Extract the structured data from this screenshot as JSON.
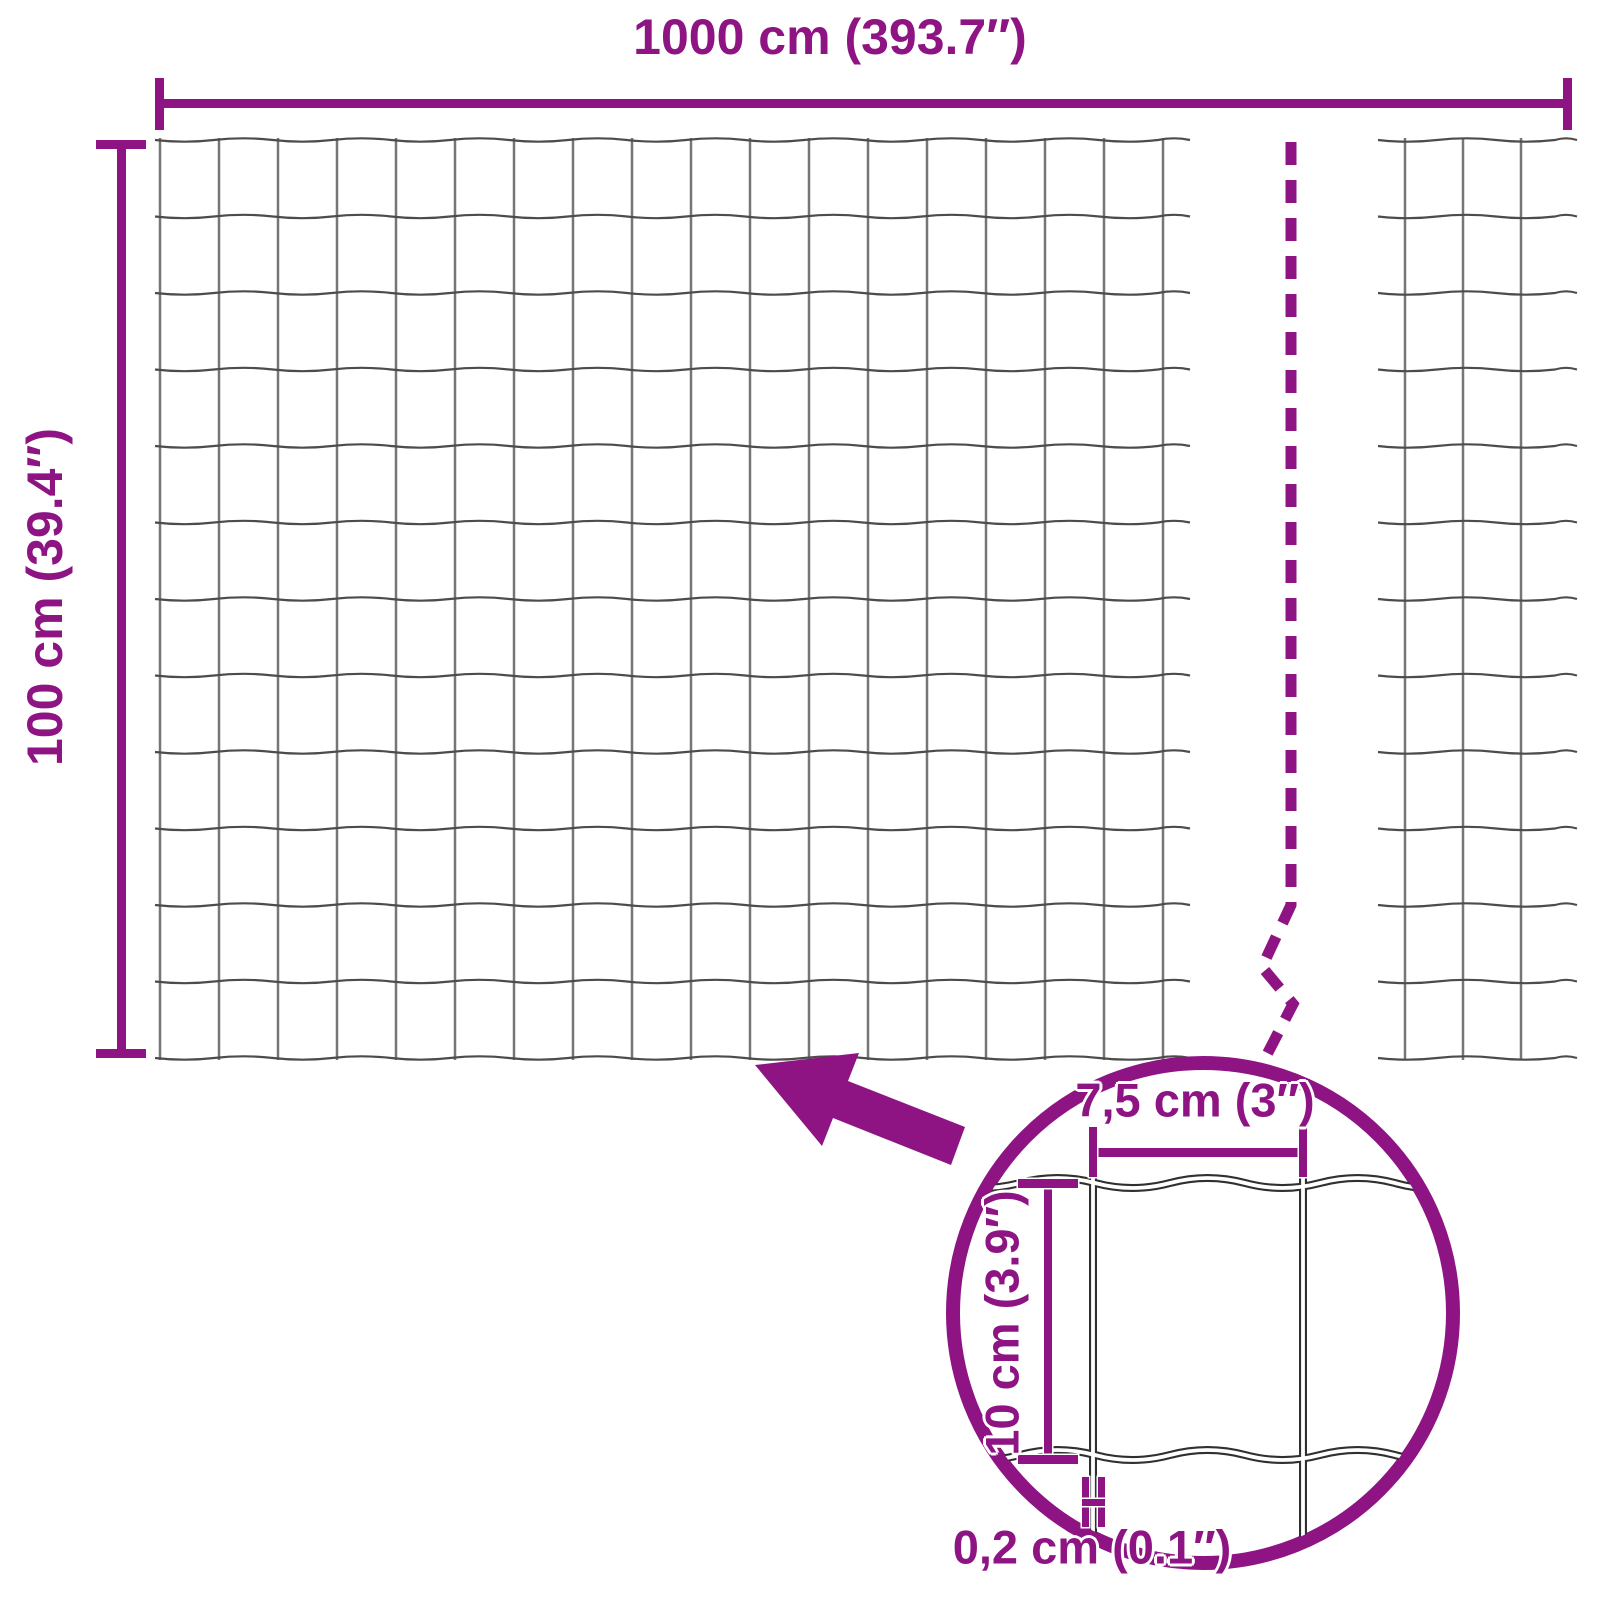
{
  "diagram": {
    "type": "wire-mesh-fence-dimension-diagram",
    "accent_color": "#8E1484",
    "wire_color_horizontal": "#4c4c4c",
    "wire_color_vertical": "#767676",
    "detail_wire_outline": "#303030",
    "labels": {
      "total_width": "1000 cm (393.7″)",
      "total_height": "100 cm (39.4″)",
      "detail_mesh_width": "7,5 cm (3″)",
      "detail_mesh_height": "10 cm (3.9″)",
      "detail_wire_thickness": "0,2 cm (0.1″)"
    },
    "mesh": {
      "main": {
        "left": 155,
        "right": 1190,
        "top": 140,
        "bottom": 1058,
        "first_vertical": 160,
        "vertical_spacing": 59,
        "vertical_count": 18,
        "row_spacing": 76.5,
        "horizontal_count": 13,
        "wave_amplitude": 1.7,
        "wave_length": 118
      },
      "right_piece": {
        "left": 1378,
        "right": 1577,
        "top": 140,
        "bottom": 1058,
        "verticals": [
          1405,
          1463,
          1521
        ],
        "row_spacing": 76.5,
        "horizontal_count": 13,
        "wave_amplitude": 1.7,
        "wave_length": 118
      },
      "detail": {
        "circle_cx": 1203,
        "circle_cy": 1313,
        "circle_r": 250,
        "vertical_xs": [
          1093,
          1303
        ],
        "horizontal_ys": [
          1183,
          1455
        ],
        "wire_top": 1165,
        "wire_bottom": 1560,
        "span_left": 945,
        "span_right": 1462,
        "wave_amplitude": 5,
        "wave_length": 150
      }
    }
  }
}
